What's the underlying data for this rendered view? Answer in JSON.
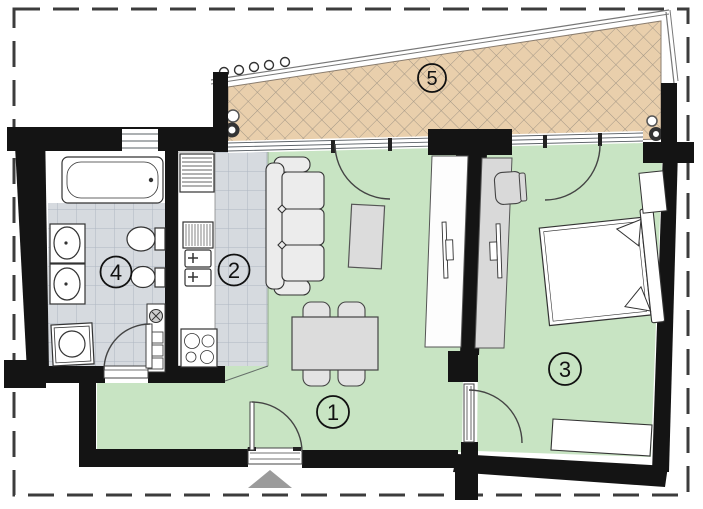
{
  "rooms": {
    "living_room": {
      "label": "1"
    },
    "kitchen": {
      "label": "2"
    },
    "bedroom": {
      "label": "3"
    },
    "bathroom": {
      "label": "4"
    },
    "terrace": {
      "label": "5"
    }
  },
  "colors": {
    "room_floor_green": "#c8e4c3",
    "tile_floor_gray": "#d6dadf",
    "tile_grid_line": "#aeb6c2",
    "terrace_paving_tan": "#e9cfac",
    "terrace_hatch_line": "#a39786",
    "wall_black": "#141414",
    "furniture_gray": "#dcdcdc",
    "sofa_gray": "#ececec",
    "entrance_marker_gray": "#9b9b9b",
    "boundary_dash_gray": "#3c3c3c"
  },
  "symbols": [
    "bathtub",
    "washbasin",
    "toilet",
    "bidet",
    "washing-machine",
    "kitchen-sink",
    "stove",
    "fridge",
    "ventilation-shaft",
    "sofa",
    "coffee-table",
    "dining-table",
    "chair",
    "tv",
    "desk",
    "bed",
    "nightstand",
    "dresser",
    "door-swing",
    "window",
    "railing",
    "floor-drain",
    "entrance-arrow"
  ]
}
